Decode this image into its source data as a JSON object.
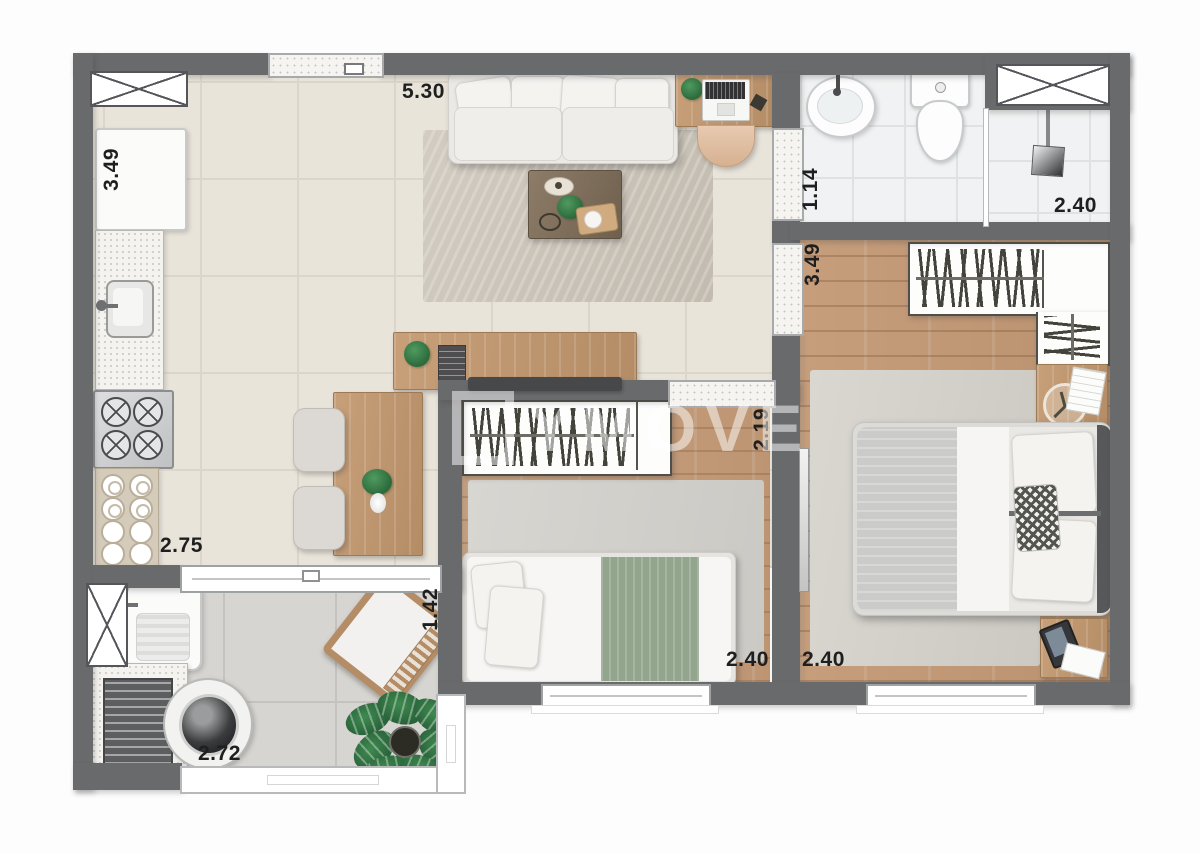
{
  "watermark": {
    "text": "YMOVE"
  },
  "dimensions": {
    "kitchen_height": "3.49",
    "living_width": "5.30",
    "bath_width": "1.14",
    "shower_width": "2.40",
    "master_height": "3.49",
    "bedroom2_hall": "2.19",
    "kitchen_width": "2.75",
    "balcony_height": "1.42",
    "bedroom2_width": "2.40",
    "master_width": "2.40",
    "service_width": "2.72"
  },
  "palette": {
    "wall": "#696a6c",
    "floor_tile": "#e9e4da",
    "wood_floor": "#c29a78",
    "bath_tile": "#f0f2f3",
    "accent_green": "#93a58d",
    "plant_green": "#2c6a3c"
  }
}
